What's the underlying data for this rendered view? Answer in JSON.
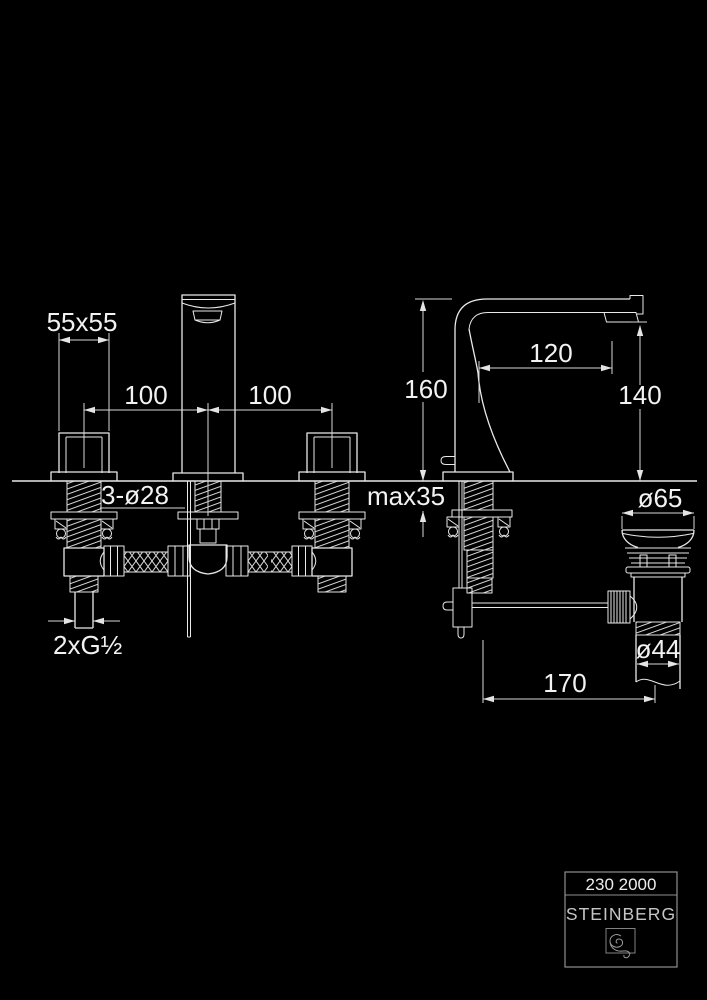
{
  "figure_type": "faucet-technical-dimension-drawing",
  "product": {
    "article_number": "230 2000",
    "brand": "STEINBERG"
  },
  "dims": {
    "handle_size": "55x55",
    "left_hole_spacing": "100",
    "right_hole_spacing": "100",
    "mounting_holes": "3-ø28",
    "max_counter_thickness": "max35",
    "spout_height": "160",
    "spout_reach": "120",
    "aerator_height": "140",
    "waste_plug_diameter": "ø65",
    "waste_pipe_diameter": "ø44",
    "rod_length": "170",
    "supply_thread": "2xG½"
  },
  "colors": {
    "background": "#000000",
    "line": "#e9e9e9",
    "dimension_line": "#d9d9d9",
    "text": "#f2f2f2",
    "plate_border": "#8f8f8f",
    "brand_text": "#c6c6c6"
  }
}
